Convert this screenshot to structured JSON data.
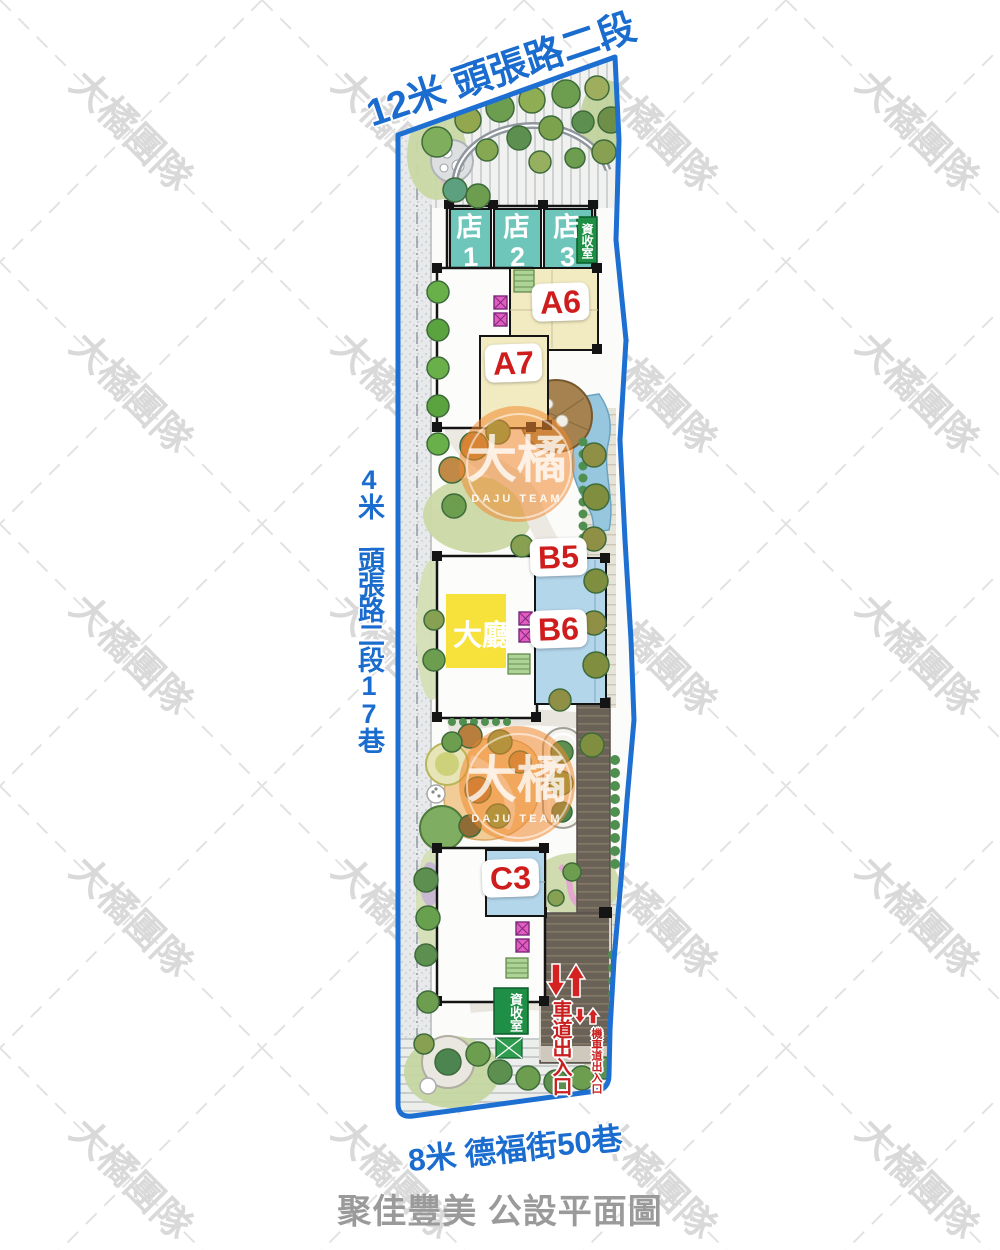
{
  "roads": {
    "top": "12米 頭張路二段",
    "left": "4米 頭張路二段17巷",
    "bottom": "8米 德福街50巷"
  },
  "title": "聚佳豐美 公設平面圖",
  "site": {
    "stores": [
      {
        "char": "店",
        "num": "1"
      },
      {
        "char": "店",
        "num": "2"
      },
      {
        "char": "店",
        "num": "3"
      }
    ],
    "units": {
      "a6": "A6",
      "a7": "A7",
      "b5": "B5",
      "b6": "B6",
      "c3": "C3"
    },
    "lobby": "大廳",
    "recycle_room_north": "資收室",
    "recycle_room_south": "資收室",
    "car_ramp": "車道出入口",
    "moto_ramp": "機車道出入口"
  },
  "watermark": {
    "team_text": "大橘團隊",
    "logo_chars": "大橘",
    "logo_sub": "DAJU TEAM"
  },
  "colors": {
    "road_label_blue": "#1a6cce",
    "boundary_blue": "#1d6fd2",
    "unit_label_red": "#cf1d1d",
    "store_teal": "#6ec5ba",
    "lobby_yellow": "#f6e23a",
    "recycle_green": "#1f8f46",
    "title_gray": "#9a9a9a"
  }
}
